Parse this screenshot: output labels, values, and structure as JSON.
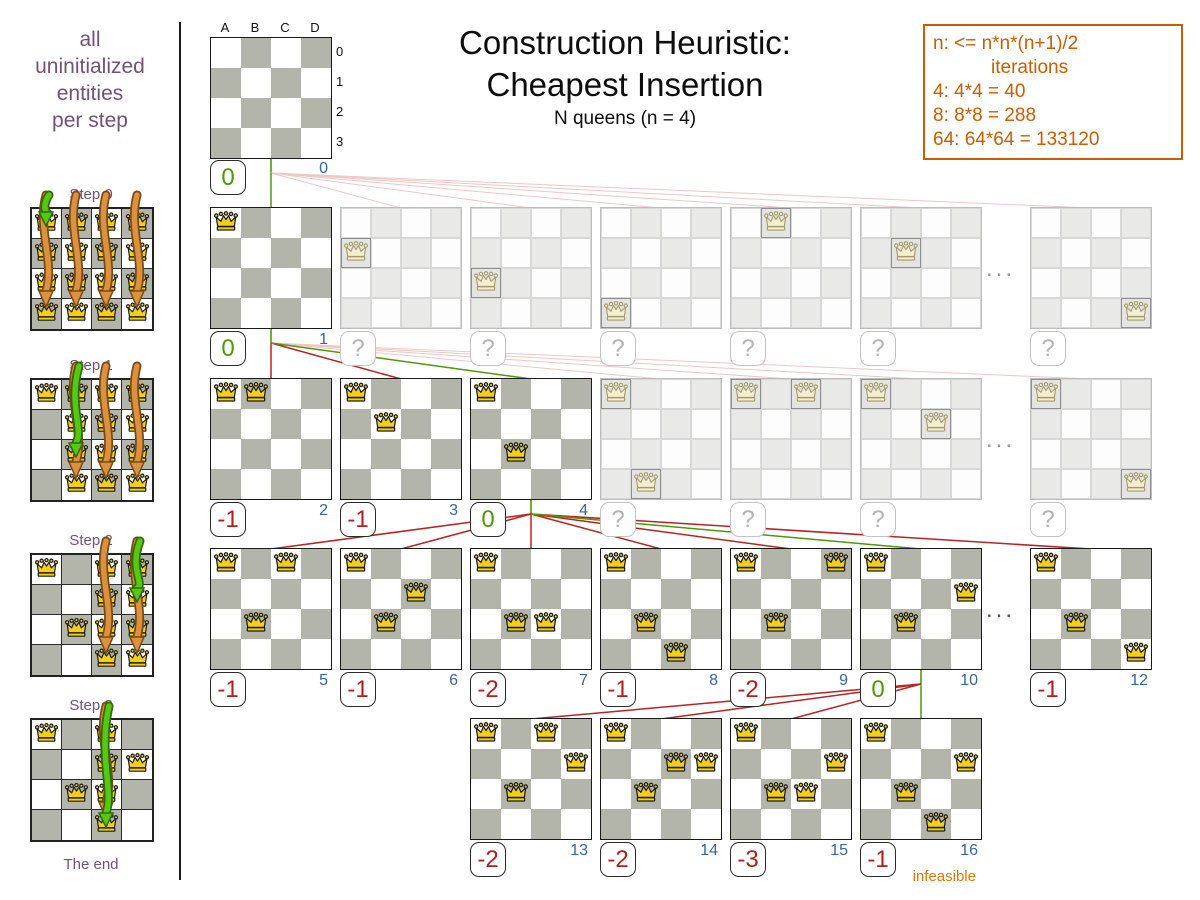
{
  "sidebar": {
    "intro": [
      "all",
      "uninitialized",
      "entities",
      "per step"
    ],
    "steps": [
      {
        "label": "Step 0",
        "fixed_queens": [],
        "arrow_columns": [
          "A",
          "B",
          "C",
          "D"
        ],
        "selected_square": "A0"
      },
      {
        "label": "Step 1",
        "fixed_queens": [
          "A0"
        ],
        "arrow_columns": [
          "B",
          "C",
          "D"
        ],
        "selected_square": "B2"
      },
      {
        "label": "Step 2",
        "fixed_queens": [
          "A0",
          "B2"
        ],
        "arrow_columns": [
          "C",
          "D"
        ],
        "selected_square": "D1"
      },
      {
        "label": "Step 3",
        "fixed_queens": [
          "A0",
          "B2",
          "D1"
        ],
        "arrow_columns": [
          "C"
        ],
        "selected_square": "C3"
      }
    ],
    "end_label": "The end"
  },
  "header": {
    "title_line1": "Construction Heuristic:",
    "title_line2": "Cheapest Insertion",
    "subtitle": "N queens (n = 4)"
  },
  "note_box": {
    "line1": "n: <= n*n*(n+1)/2",
    "line2": "iterations",
    "line3": "4: 4*4 = 40",
    "line4": "8: 8*8 = 288",
    "line5": "64: 64*64 = 133120"
  },
  "root_board": {
    "col_labels": [
      "A",
      "B",
      "C",
      "D"
    ],
    "row_labels": [
      "0",
      "1",
      "2",
      "3"
    ],
    "queens": [],
    "score": "0",
    "iteration": "0"
  },
  "ellipsis": "...",
  "infeasible_label": "infeasible",
  "tree_rows": [
    {
      "parent_slot": null,
      "dots": true,
      "boards": [
        {
          "slot": 0,
          "queens": [
            "A0"
          ],
          "score": "0",
          "score_color": "green",
          "iteration": "1",
          "link": "green",
          "faded": false
        },
        {
          "slot": 1,
          "queens": [
            "A1"
          ],
          "score": "?",
          "score_color": "gray",
          "iteration": "",
          "link": "faint",
          "faded": true
        },
        {
          "slot": 2,
          "queens": [
            "A2"
          ],
          "score": "?",
          "score_color": "gray",
          "iteration": "",
          "link": "faint",
          "faded": true
        },
        {
          "slot": 3,
          "queens": [
            "A3"
          ],
          "score": "?",
          "score_color": "gray",
          "iteration": "",
          "link": "faint",
          "faded": true
        },
        {
          "slot": 4,
          "queens": [
            "B0"
          ],
          "score": "?",
          "score_color": "gray",
          "iteration": "",
          "link": "faint",
          "faded": true
        },
        {
          "slot": 5,
          "queens": [
            "B1"
          ],
          "score": "?",
          "score_color": "gray",
          "iteration": "",
          "link": "faint",
          "faded": true
        },
        {
          "slot": 6,
          "queens": [
            "D3"
          ],
          "score": "?",
          "score_color": "gray",
          "iteration": "",
          "link": "faint",
          "faded": true
        }
      ]
    },
    {
      "parent_slot": 0,
      "dots": true,
      "boards": [
        {
          "slot": 0,
          "queens": [
            "A0",
            "B0"
          ],
          "score": "-1",
          "score_color": "red",
          "iteration": "2",
          "link": "red",
          "faded": false
        },
        {
          "slot": 1,
          "queens": [
            "A0",
            "B1"
          ],
          "score": "-1",
          "score_color": "red",
          "iteration": "3",
          "link": "red",
          "faded": false
        },
        {
          "slot": 2,
          "queens": [
            "A0",
            "B2"
          ],
          "score": "0",
          "score_color": "green",
          "iteration": "4",
          "link": "green",
          "faded": false
        },
        {
          "slot": 3,
          "queens": [
            "A0",
            "B3"
          ],
          "score": "?",
          "score_color": "gray",
          "iteration": "",
          "link": "faint",
          "faded": true
        },
        {
          "slot": 4,
          "queens": [
            "A0",
            "C0"
          ],
          "score": "?",
          "score_color": "gray",
          "iteration": "",
          "link": "faint",
          "faded": true
        },
        {
          "slot": 5,
          "queens": [
            "A0",
            "C1"
          ],
          "score": "?",
          "score_color": "gray",
          "iteration": "",
          "link": "faint",
          "faded": true
        },
        {
          "slot": 6,
          "queens": [
            "A0",
            "D3"
          ],
          "score": "?",
          "score_color": "gray",
          "iteration": "",
          "link": "faint",
          "faded": true
        }
      ]
    },
    {
      "parent_slot": 2,
      "dots": true,
      "boards": [
        {
          "slot": 0,
          "queens": [
            "A0",
            "C0",
            "B2"
          ],
          "score": "-1",
          "score_color": "red",
          "iteration": "5",
          "link": "red",
          "faded": false
        },
        {
          "slot": 1,
          "queens": [
            "A0",
            "C1",
            "B2"
          ],
          "score": "-1",
          "score_color": "red",
          "iteration": "6",
          "link": "red",
          "faded": false
        },
        {
          "slot": 2,
          "queens": [
            "A0",
            "B2",
            "C2"
          ],
          "score": "-2",
          "score_color": "red",
          "iteration": "7",
          "link": "red",
          "faded": false
        },
        {
          "slot": 3,
          "queens": [
            "A0",
            "B2",
            "C3"
          ],
          "score": "-1",
          "score_color": "red",
          "iteration": "8",
          "link": "red",
          "faded": false
        },
        {
          "slot": 4,
          "queens": [
            "A0",
            "D0",
            "B2"
          ],
          "score": "-2",
          "score_color": "red",
          "iteration": "9",
          "link": "red",
          "faded": false
        },
        {
          "slot": 5,
          "queens": [
            "A0",
            "B2",
            "D1"
          ],
          "score": "0",
          "score_color": "green",
          "iteration": "10",
          "link": "green",
          "faded": false
        },
        {
          "slot": 6,
          "queens": [
            "A0",
            "B2",
            "D3"
          ],
          "score": "-1",
          "score_color": "red",
          "iteration": "12",
          "link": "red",
          "faded": false
        }
      ]
    },
    {
      "parent_slot": 5,
      "dots": false,
      "boards": [
        {
          "slot": 2,
          "queens": [
            "A0",
            "C0",
            "D1",
            "B2"
          ],
          "score": "-2",
          "score_color": "red",
          "iteration": "13",
          "link": "red",
          "faded": false
        },
        {
          "slot": 3,
          "queens": [
            "A0",
            "C1",
            "D1",
            "B2"
          ],
          "score": "-2",
          "score_color": "red",
          "iteration": "14",
          "link": "red",
          "faded": false
        },
        {
          "slot": 4,
          "queens": [
            "A0",
            "D1",
            "B2",
            "C2"
          ],
          "score": "-3",
          "score_color": "red",
          "iteration": "15",
          "link": "red",
          "faded": false
        },
        {
          "slot": 5,
          "queens": [
            "A0",
            "D1",
            "B2",
            "C3"
          ],
          "score": "-1",
          "score_color": "red",
          "iteration": "16",
          "link": "green",
          "faded": false,
          "note": "infeasible"
        }
      ]
    }
  ],
  "colors": {
    "purple": "#75507b",
    "orange": "#ce5c00",
    "blue": "#3465a4",
    "score_red": "#b21f1f",
    "score_green": "#4e9a06",
    "line_red": "#bb2222",
    "line_green": "#4e9a06",
    "line_faint": "#eec6c6",
    "board_dark_cell": "#b3b5aa",
    "queen_gold": "#f3cf17",
    "arrow_orange": "#da9140",
    "arrow_green": "#58c713"
  }
}
